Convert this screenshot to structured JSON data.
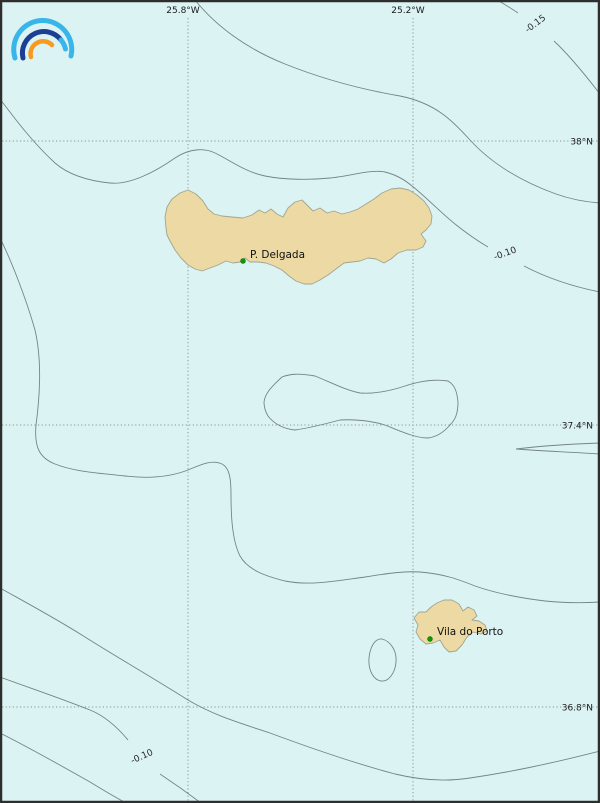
{
  "map": {
    "type": "geographic-contour-map",
    "region": "Azores (São Miguel and Santa Maria islands)",
    "gridlines": {
      "meridians": [
        {
          "label": "25.8°W",
          "x": 188
        },
        {
          "label": "25.2°W",
          "x": 413
        }
      ],
      "parallels": [
        {
          "label": "38°N",
          "y": 141
        },
        {
          "label": "37.4°N",
          "y": 425
        },
        {
          "label": "36.8°N",
          "y": 707
        }
      ]
    },
    "contour_labels": [
      {
        "text": "-0.15",
        "x": 537,
        "y": 26,
        "rotation": -37
      },
      {
        "text": "-0.10",
        "x": 506,
        "y": 256,
        "rotation": -20
      },
      {
        "text": "-0.10",
        "x": 143,
        "y": 759,
        "rotation": -24
      }
    ],
    "places": [
      {
        "name": "P. Delgada",
        "marker_x": 243,
        "marker_y": 261,
        "label_x": 250,
        "label_y": 258
      },
      {
        "name": "Vila do Porto",
        "marker_x": 430,
        "marker_y": 639,
        "label_x": 437,
        "label_y": 635
      }
    ]
  },
  "colors": {
    "ocean": "#dcf3f4",
    "island_fill": "#ecd9a4",
    "island_stroke": "#9fa68f",
    "contour": "#6e7e80",
    "grid": "#8a9494",
    "frame": "#2e2e2e",
    "marker_green": "#0f9b00",
    "logo_light_blue": "#38b5e9",
    "logo_dark_blue": "#1d3f93",
    "logo_orange": "#f79a1e"
  },
  "logo": {
    "name": "rainbow-arcs-logo"
  }
}
